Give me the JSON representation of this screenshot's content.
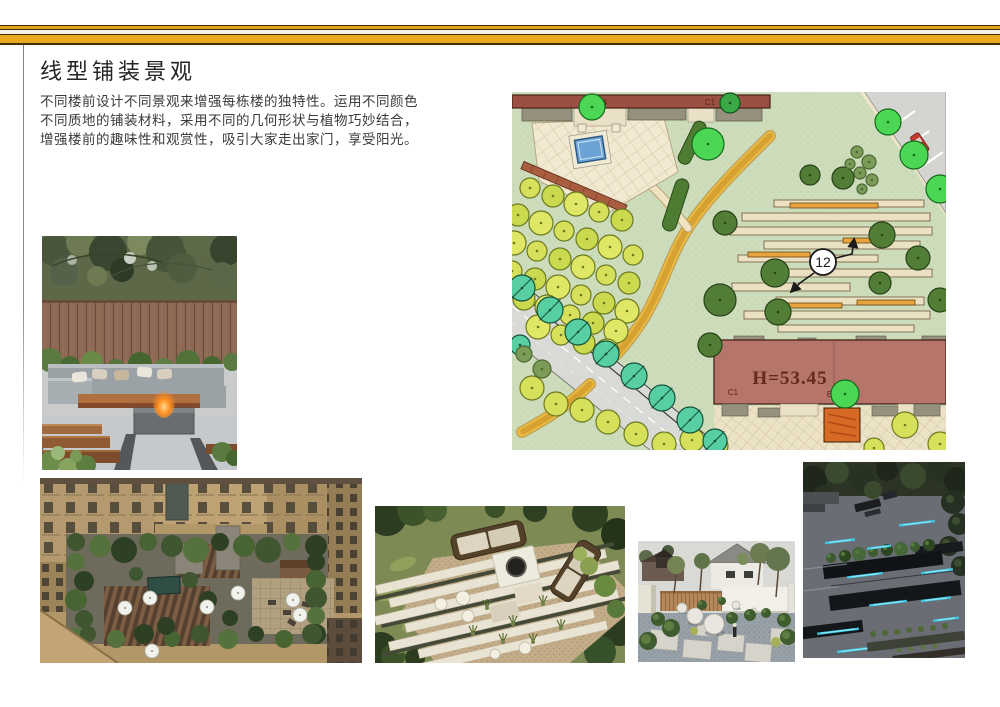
{
  "slide": {
    "title": "线型铺装景观",
    "paragraph": [
      "不同楼前设计不同景观来增强每栋楼的独特性。运用不同颜色",
      "不同质地的铺装材料，采用不同的几何形状与植物巧妙结合，",
      "增强楼前的趣味性和观赏性，吸引大家走出家门，享受阳光。"
    ]
  },
  "plan": {
    "labels": {
      "top_left": "B4-B4",
      "top_right": "C1",
      "height": "H=53.45",
      "bottom_left": "C1",
      "bottom_center": "B4-B4",
      "callout": "12"
    }
  },
  "theme": {
    "band_gold": "#ECA81E",
    "band_gold_thin": "#E2A21B",
    "band_dark_brown": "#41300E",
    "band_cream": "#F6F2E2",
    "plan_grass": "#CDDCBB",
    "plan_path_yellow": "#E9BA43",
    "plan_building_red": "#B5756A",
    "led_cyan": "#3FC8E4"
  }
}
